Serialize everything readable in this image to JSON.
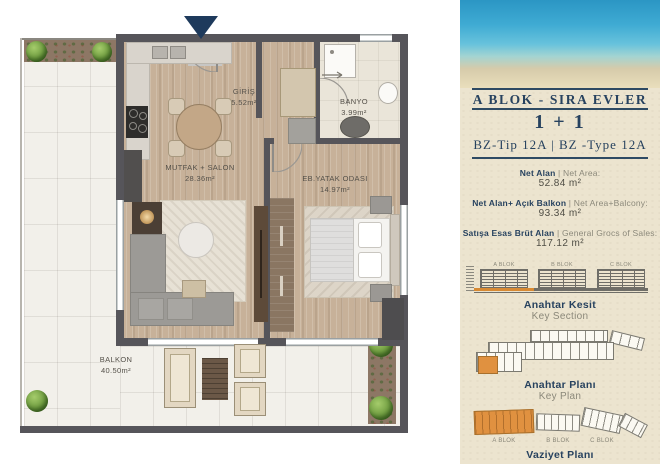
{
  "floor_plan": {
    "entrance_marker_color": "#1e3a5c",
    "rooms": [
      {
        "name": "GİRİŞ",
        "area": "5.52m²"
      },
      {
        "name": "BANYO",
        "area": "3.99m²"
      },
      {
        "name": "MUTFAK + SALON",
        "area": "28.36m²"
      },
      {
        "name": "EB.YATAK ODASI",
        "area": "14.97m²"
      },
      {
        "name": "BALKON",
        "area": "40.50m²"
      }
    ]
  },
  "info_panel": {
    "block_title": "A BLOK - SIRA EVLER",
    "unit_type": "1 + 1",
    "type_line": "BZ-Tip 12A  |  BZ -Type 12A",
    "areas": [
      {
        "label_tr": "Net Alan",
        "sep": "|",
        "label_en": "Net Area:",
        "value": "52.84 m²"
      },
      {
        "label_tr": "Net Alan+ Açık Balkon",
        "sep": "|",
        "label_en": "Net Area+Balcony:",
        "value": "93.34 m²"
      },
      {
        "label_tr": "Satışa Esas Brüt Alan",
        "sep": "|",
        "label_en": "General Grocs of Sales:",
        "value": "117.12 m²"
      }
    ],
    "section": {
      "blocks": [
        "A BLOK",
        "B BLOK",
        "C BLOK"
      ],
      "caption_tr": "Anahtar Kesit",
      "caption_en": "Key Section"
    },
    "key_plan": {
      "caption_tr": "Anahtar Planı",
      "caption_en": "Key Plan"
    },
    "site_plan": {
      "blocks": [
        "A BLOK",
        "B BLOK",
        "C BLOK"
      ],
      "caption_tr": "Vaziyet Planı"
    },
    "colors": {
      "navy": "#27425f",
      "orange": "#e0903f",
      "sand": "#ece4cf"
    }
  }
}
